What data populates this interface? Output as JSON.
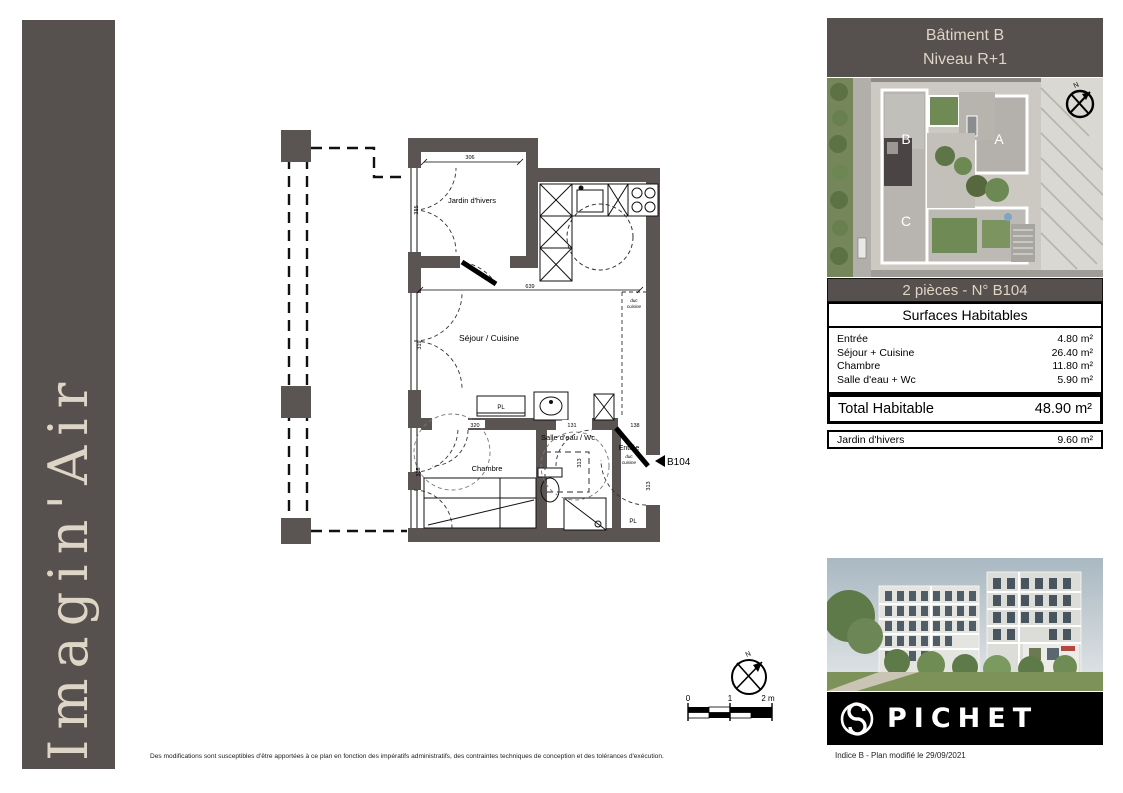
{
  "brand": {
    "name": "Imagin'Air"
  },
  "right_panel": {
    "header": {
      "line1": "Bâtiment B",
      "line2": "Niveau R+1"
    },
    "site": {
      "building_a": "A",
      "building_b": "B",
      "building_c": "C",
      "north": "N"
    },
    "unit_bar": "2 pièces - N° B104",
    "surfaces": {
      "title": "Surfaces Habitables",
      "rows": [
        {
          "label": "Entrée",
          "value": "4.80 m²"
        },
        {
          "label": "Séjour + Cuisine",
          "value": "26.40 m²"
        },
        {
          "label": "Chambre",
          "value": "11.80 m²"
        },
        {
          "label": "Salle d'eau + Wc",
          "value": "5.90 m²"
        }
      ],
      "total": {
        "label": "Total Habitable",
        "value": "48.90 m²"
      },
      "annex": {
        "label": "Jardin d'hivers",
        "value": "9.60 m²"
      }
    },
    "logo": {
      "name": "PICHET"
    },
    "footer_note": "Indice B - Plan modifié le 29/09/2021"
  },
  "floorplan": {
    "rooms": {
      "jardin": "Jardin d'hivers",
      "sejour": "Séjour / Cuisine",
      "chambre": "Chambre",
      "sdb": "Salle d'eau / Wc",
      "entree": "Entrée"
    },
    "annotations": {
      "duc_line1": "duc",
      "duc_line2": "cuisine",
      "pl1": "PL",
      "pl2": "PL",
      "unit_ref": "B104"
    },
    "dims": {
      "d306": "306",
      "d315a": "315",
      "d639": "639",
      "d319": "319",
      "d320": "320",
      "d131": "131",
      "d138": "138",
      "d315b": "315",
      "d313a": "313",
      "d313b": "313"
    }
  },
  "scalebar": {
    "t0": "0",
    "t1": "1",
    "t2": "2 m",
    "north": "N"
  },
  "disclaimer": "Des modifications sont susceptibles d'être apportées à ce plan en fonction des impératifs administratifs, des contraintes techniques de conception et des tolérances d'exécution.",
  "colors": {
    "dark": "#56504e",
    "cream": "#ddd5c6",
    "wall": "#5a5452"
  }
}
